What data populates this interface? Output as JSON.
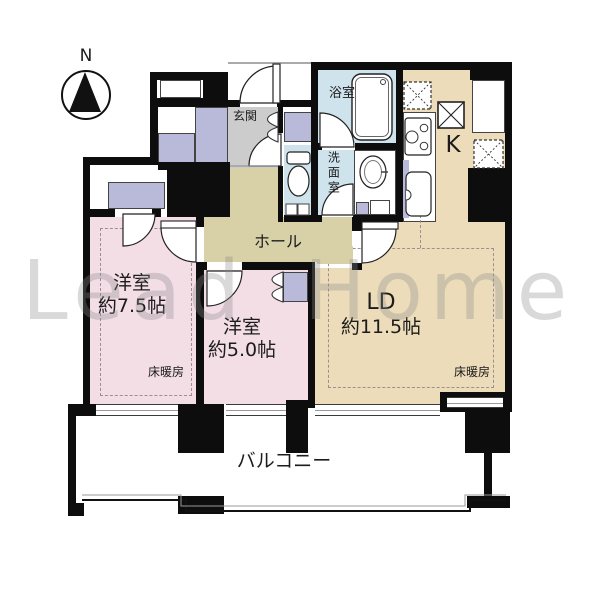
{
  "compass": {
    "north": "N"
  },
  "watermark": {
    "text": "Lead Home"
  },
  "rooms": {
    "western75": {
      "name": "洋室",
      "size": "約7.5帖",
      "heating": "床暖房"
    },
    "western50": {
      "name": "洋室",
      "size": "約5.0帖"
    },
    "ld": {
      "name": "LD",
      "size": "約11.5帖",
      "heating": "床暖房"
    },
    "kitchen": {
      "name": "K"
    },
    "entrance": {
      "name": "玄関"
    },
    "hall": {
      "name": "ホール"
    },
    "bathroom": {
      "name": "浴室"
    },
    "washroom": {
      "name": "洗面室"
    },
    "balcony": {
      "name": "バルコニー"
    }
  },
  "icons": [
    "north-arrow-icon",
    "bathtub-icon",
    "toilet-icon",
    "washbasin-icon",
    "stove-icon",
    "kitchen-sink-icon",
    "door-swing-icon",
    "folding-door-icon",
    "pillar-x-icon"
  ],
  "colors": {
    "wall": "#0d0d0d",
    "room-pink": "#f3dee6",
    "room-beige": "#ecdcba",
    "hall-khaki": "#d8d0a6",
    "wet-blue": "#cfe3ed",
    "entry-gray": "#cccccc",
    "closet-lavender": "#b9b9d9",
    "line": "#444444",
    "watermark-gray": "#8a8a8a"
  }
}
